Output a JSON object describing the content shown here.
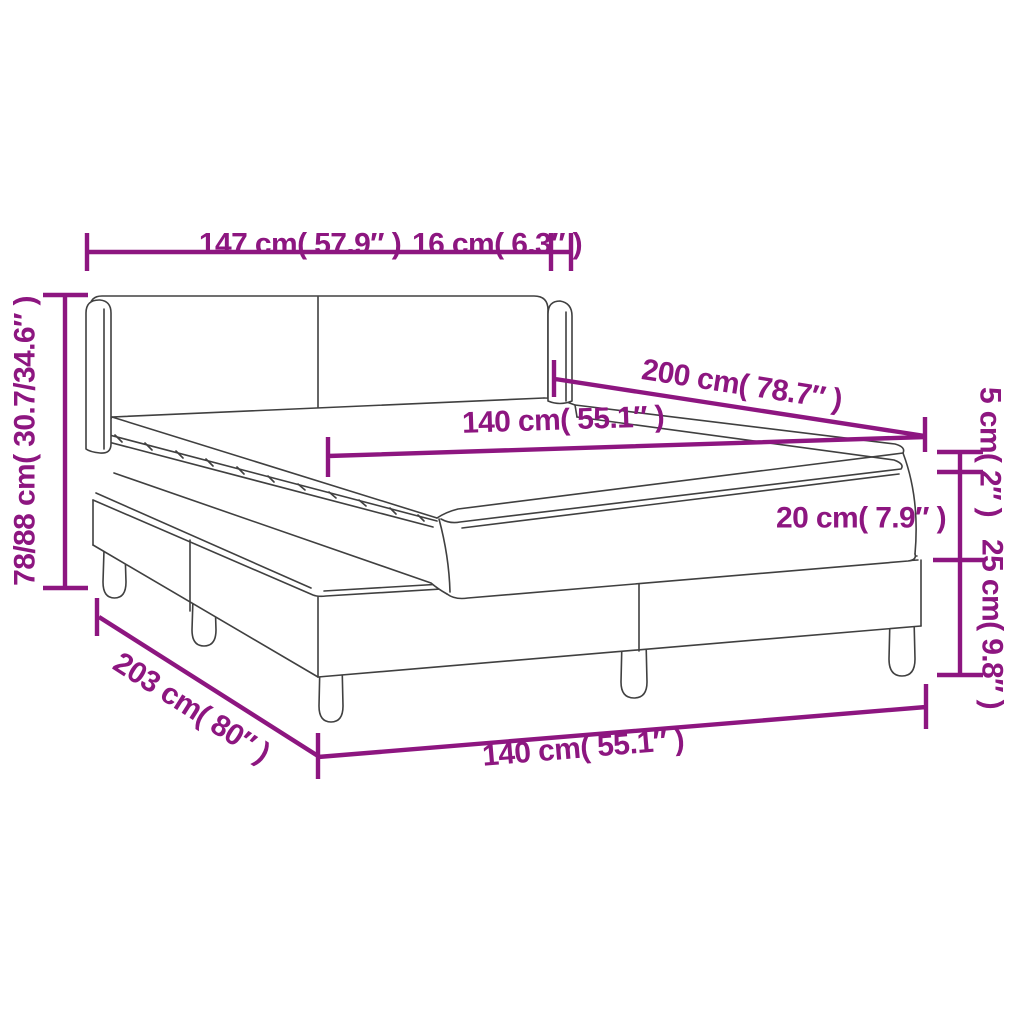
{
  "diagram": {
    "subject": "Box spring bed with headboard, mattress and topper — dimension drawing",
    "colors": {
      "dimension_accent": "#8d1680",
      "artwork_line": "#404040",
      "background": "#ffffff"
    },
    "labels": {
      "headboard_width": "147 cm( 57.9″ )",
      "headboard_side_depth": "16 cm( 6.3″ )",
      "headboard_height": "78/88 cm( 30.7/34.6″ )",
      "bed_length_top": "200 cm( 78.7″ )",
      "mattress_width_top": "140 cm( 55.1″ )",
      "topper_thickness": "5 cm( 2″ )",
      "mattress_thickness": "20 cm( 7.9″ )",
      "base_height": "25 cm( 9.8″ )",
      "bed_length_bottom": "203 cm( 80″ )",
      "bed_width_bottom": "140 cm( 55.1″ )"
    },
    "values": {
      "headboard_width_cm": "147",
      "headboard_width_in": "57.9",
      "headboard_side_depth_cm": "16",
      "headboard_side_depth_in": "6.3",
      "headboard_height_cm": "78/88",
      "headboard_height_in": "30.7/34.6",
      "bed_length_cm": "200",
      "bed_length_in": "78.7",
      "mattress_width_cm": "140",
      "mattress_width_in": "55.1",
      "topper_thickness_cm": "5",
      "topper_thickness_in": "2",
      "mattress_thickness_cm": "20",
      "mattress_thickness_in": "7.9",
      "base_height_cm": "25",
      "base_height_in": "9.8",
      "frame_length_cm": "203",
      "frame_length_in": "80"
    }
  }
}
